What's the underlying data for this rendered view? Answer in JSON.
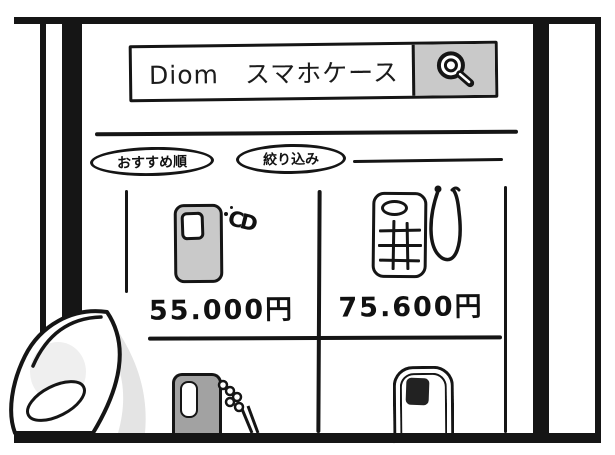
{
  "search_bar": {
    "query": "Diom　スマホケース"
  },
  "toolbar": {
    "sort_label": "おすすめ順",
    "filter_label": "絞り込み"
  },
  "products": {
    "row1": [
      {
        "charm": "CD",
        "price": "55.000円"
      },
      {
        "price": "75.600円"
      }
    ]
  },
  "colors": {
    "ink": "#151515",
    "search_button_gray": "#c9c9c9",
    "case_gray": "#c9c9c9",
    "dark_case_gray": "#a2a2a2",
    "thumb_shadow_gray": "#e4e4e4"
  }
}
